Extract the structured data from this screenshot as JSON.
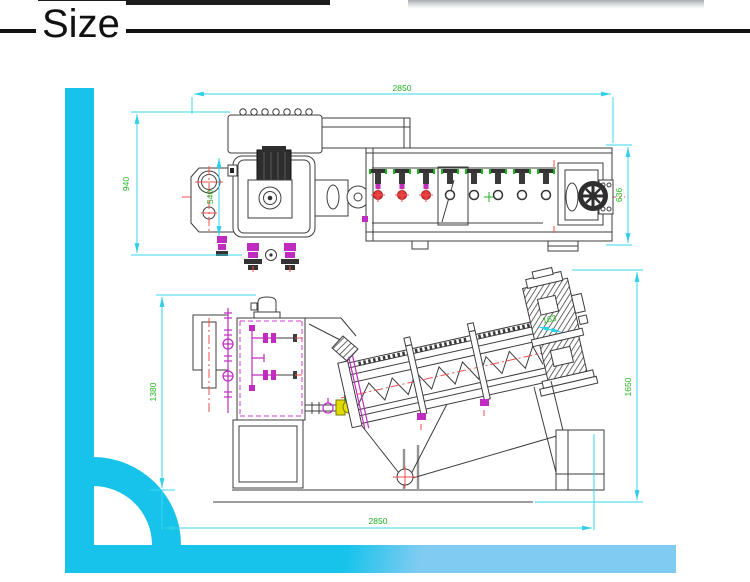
{
  "title": {
    "text": "Size"
  },
  "drawing": {
    "type": "engineering-drawing",
    "subject": "screw press machine - top view and side elevation",
    "top_view": {
      "label": "top view",
      "dims": {
        "length": "2850",
        "width": "940",
        "hub": "540",
        "end_width": "636"
      }
    },
    "side_view": {
      "label": "side elevation",
      "dims": {
        "feed_height": "1380",
        "drive_height": "1650",
        "base_length": "2850",
        "motor_offset": "163"
      }
    },
    "colors": {
      "accent_cyan": "#17c3eb",
      "accent_light_blue": "#80cbf1",
      "dim_line": "#38d4ec",
      "dim_text_green": "#1eb41e",
      "centerline_red": "#f24d4d",
      "valve_magenta": "#bf2cbf",
      "valve_yellow": "#e0da00",
      "drawing_line": "#3d3d3d",
      "top_bar_black": "#1c1c1c"
    }
  }
}
